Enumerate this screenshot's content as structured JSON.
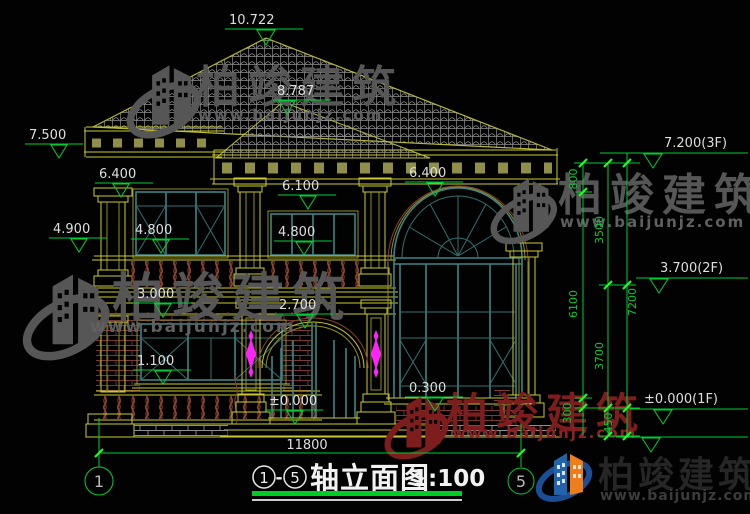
{
  "markers": {
    "peak": "10.722",
    "ridge": "8.787",
    "eave_left": "7.500",
    "left_64": "6.400",
    "left_49": "4.900",
    "left_48": "4.800",
    "mid_61": "6.100",
    "mid_48": "4.800",
    "right_64": "6.400",
    "mid_30": "3.000",
    "mid_27": "2.700",
    "mid_11": "1.100",
    "door_zero": "±0.000",
    "right_03": "0.300",
    "f3": "7.200(3F)",
    "f2": "3.700(2F)",
    "f1": "±0.000(1F)"
  },
  "vdims": {
    "v800": "800",
    "v3500": "3500",
    "v6100": "6100",
    "v3700": "3700",
    "v7200": "7200",
    "v300": "300",
    "v450": "450"
  },
  "hdim_total": "11800",
  "axis": {
    "left": "1",
    "right": "5"
  },
  "title": {
    "a": "1",
    "sep": "-",
    "b": "5",
    "text": "轴立面图",
    "scale": "1:100"
  },
  "watermark": {
    "brand": "柏竣建筑",
    "url": "www.baijunjz.com"
  },
  "footer": {
    "brand": "柏竣建筑",
    "url": "www.baijunjz.com"
  },
  "colors": {
    "dim_green": "#00cd32",
    "cad_yellow": "#c9c92e",
    "window_teal": "#3f8484",
    "brick_maroon": "#7a3838",
    "ornament_magenta": "#ff22ff",
    "watermark_gray": "#565656",
    "watermark_red": "#7e1d1d",
    "logo_blue": "#1c4e96",
    "logo_orange": "#ef7d1a"
  }
}
